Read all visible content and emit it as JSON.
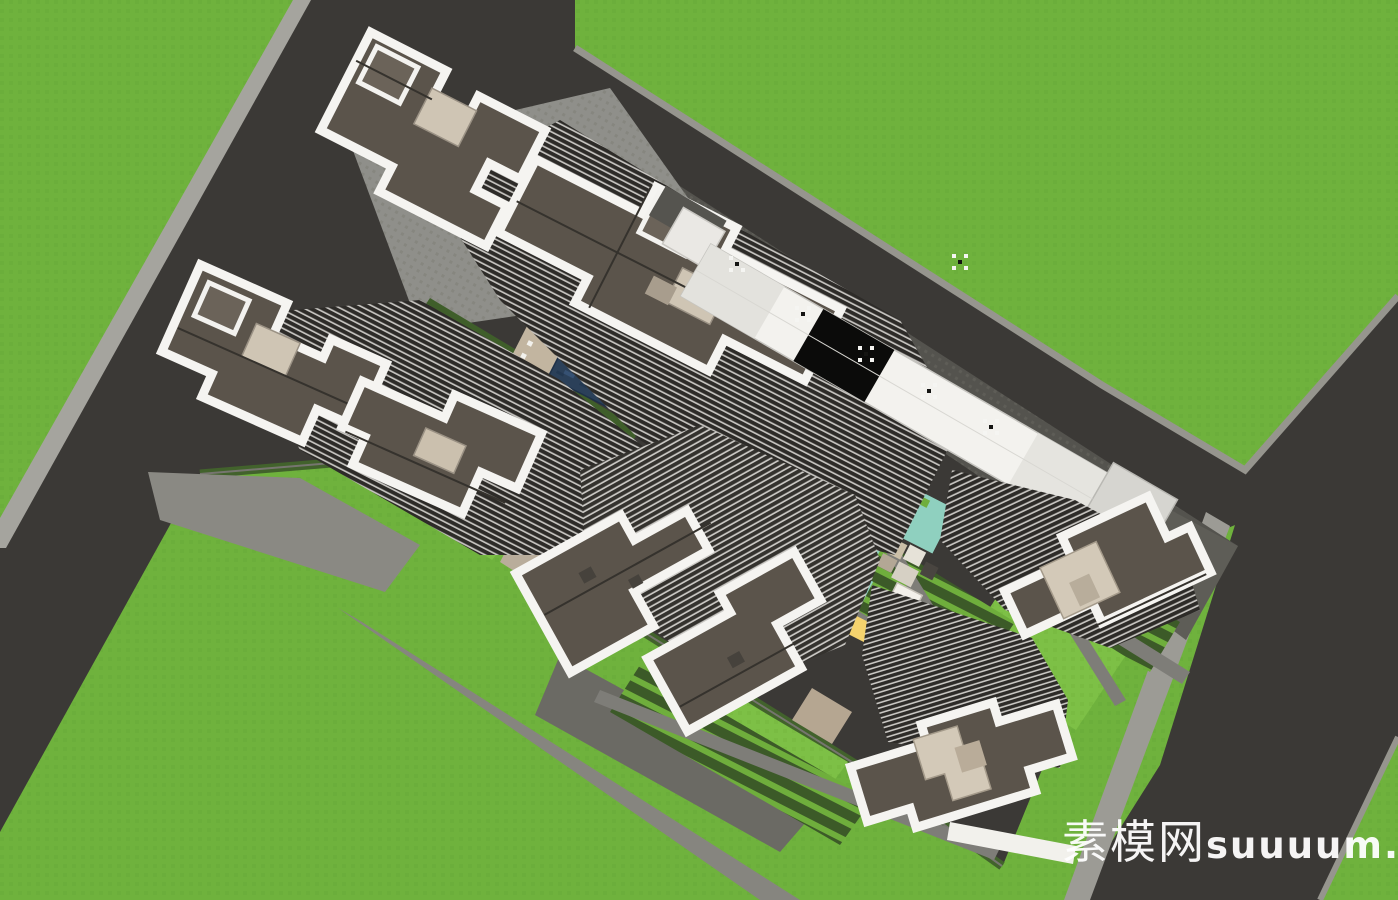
{
  "watermark": {
    "text": "素模网suuuum.com",
    "cjk": "素模网",
    "latin": "suuuum.com",
    "color": "#ffffff"
  },
  "scene": {
    "description": "Aerial top-down 3D rendering (SketchUp style) of a residential master plan: eight high-rise towers with white parapet roofs around a landscaped courtyard with swimming pools, playground and a long white commercial podium, bounded by dark asphalt roads and bright green parcels.",
    "tower_roof_count": 8
  },
  "palette": {
    "asphalt": "#3b3936",
    "grass": "#6fb23d",
    "lawn": "#7dc046",
    "hedge": "#3c5a28",
    "curb": "#96958e",
    "sidewalk": "#a5a49e",
    "plaza_dark": "#54534e",
    "plaza_light": "#8f8f8a",
    "path": "#7e7d78",
    "roof": "#5b544b",
    "parapet": "#f5f4f1",
    "facade_dark": "#2d2b28",
    "facade_light": "#c6c4c0",
    "penthouse": "#cfc5b4",
    "water": "#2b4059",
    "water_light": "#47688c",
    "play_teal": "#8fd0bf",
    "play_yellow": "#f5d36e",
    "podium_white": "#f3f2ee",
    "glass_black": "#0b0b0a",
    "deck_tan": "#c2b5a0"
  }
}
